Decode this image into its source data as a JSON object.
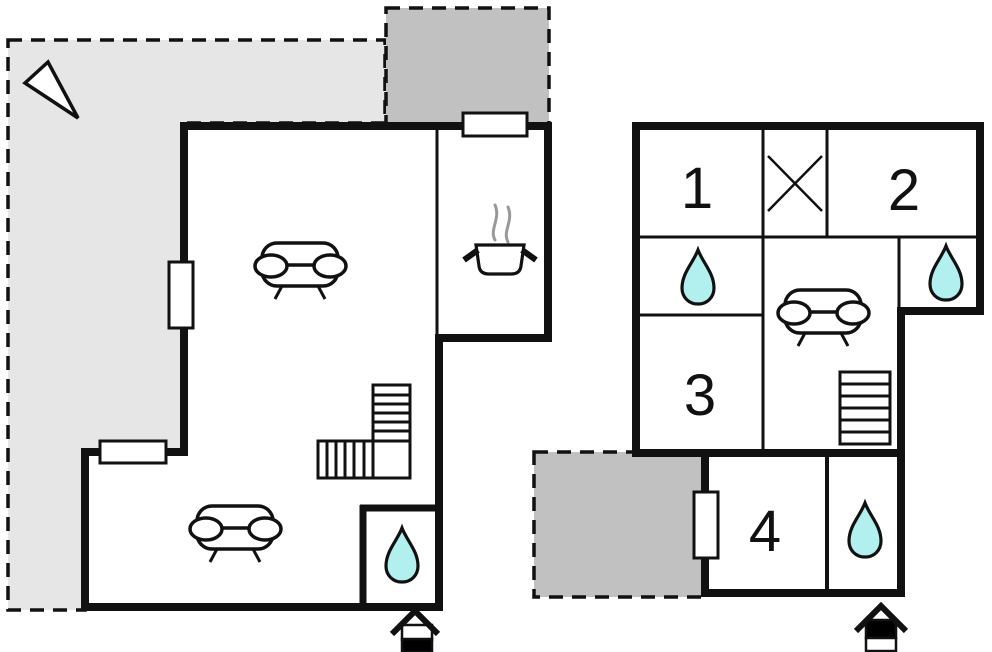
{
  "title": "two-storey holiday-home floor plan",
  "colors": {
    "background": "#ffffff",
    "wall": "#111111",
    "terrace_light": "#e6e6e6",
    "terrace_dark": "#c1c1c1",
    "water_fill": "#b2f0f0",
    "steam": "#999999",
    "white": "#ffffff",
    "black": "#000000"
  },
  "ground_floor": {
    "name": "ground floor",
    "features": [
      "north-arrow",
      "terrace",
      "roof-terrace",
      "sofa",
      "sofa",
      "kitchen-stove-pot",
      "l-shaped-staircase",
      "bathroom-water-drop",
      "entrance-door"
    ],
    "window_count": "3"
  },
  "upper_floor": {
    "name": "upper floor",
    "rooms": [
      {
        "label": "1"
      },
      {
        "label": "2"
      },
      {
        "label": "3"
      },
      {
        "label": "4"
      }
    ],
    "features": [
      "skylight-cross",
      "bathroom-water-drop",
      "bathroom-water-drop",
      "sofa",
      "staircase",
      "terrace",
      "bathroom-water-drop",
      "entrance-door"
    ],
    "window_count": "1"
  }
}
